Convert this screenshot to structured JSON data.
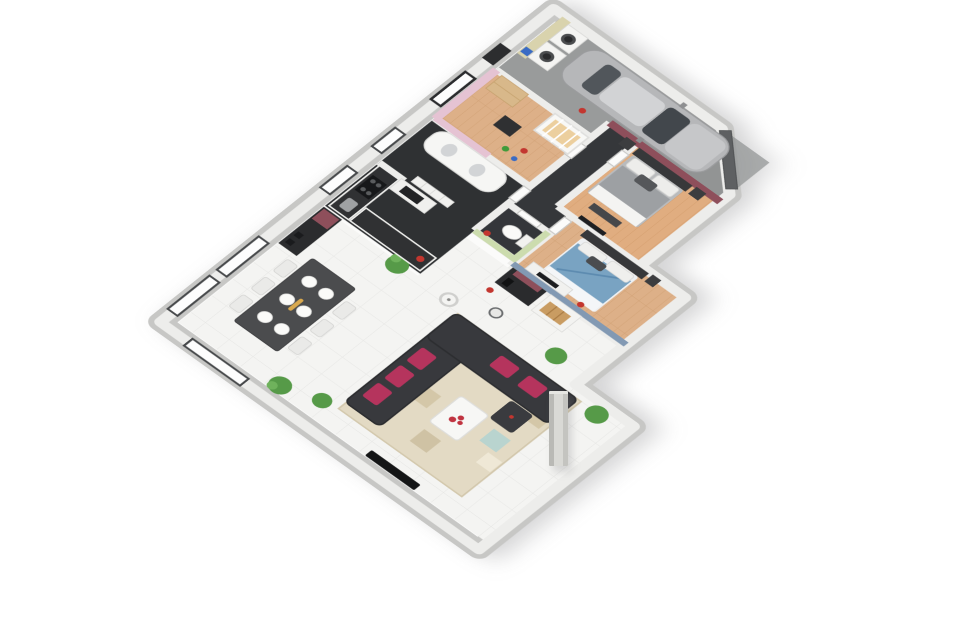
{
  "scene": {
    "type": "3d-isometric-floor-plan",
    "title": "3D isometric floor plan of a single-storey house with garage",
    "camera": "axonometric view from the south-east, plan rotated about 40 degrees",
    "background": "#ffffff",
    "palette": {
      "tile_floor": "#f4f4f2",
      "tile_grid": "#e6e6e4",
      "wood_floor": "#ddb088",
      "wood_floor_master": "#e0ad80",
      "dark_tile_floor": "#2f3133",
      "concrete_floor": "#999b9b",
      "wall": "#ededeb",
      "plinth": "#c7c7c5",
      "accent_pink": "#e5c3d3",
      "accent_green": "#ccdcae",
      "accent_burgundy": "#8e4f5b",
      "accent_blue_gray": "#8299b3",
      "sofa_dark": "#38393d",
      "cushion_magenta": "#b5345d",
      "car_silver": "#b6b7b9",
      "bed_blue": "#79a3c2",
      "bed_gray": "#9da0a3",
      "garage_door_gray": "#5e6062",
      "window_frame": "#46484a",
      "plant_green": "#569a48",
      "red_accent": "#c3362f"
    },
    "rooms": [
      {
        "id": "living",
        "name": "Living and dining room",
        "floor": "white tile",
        "furniture": [
          "corner sofa with magenta cushions",
          "patterned area rug",
          "white coffee table with red flowers",
          "dark ottoman",
          "flat TV",
          "dining table with six white place settings",
          "six chairs",
          "black sideboard with burgundy door",
          "potted plants",
          "floor lamp"
        ]
      },
      {
        "id": "kitchen",
        "name": "Kitchen",
        "floor": "dark tile",
        "furniture": [
          "L-shaped counter with black worktop",
          "cooktop",
          "sink",
          "tall oven column",
          "red bowl"
        ]
      },
      {
        "id": "bathroom",
        "name": "Bathroom",
        "floor": "dark tile",
        "furniture": [
          "curved white vanity with twin basins",
          "drawer column",
          "small window"
        ]
      },
      {
        "id": "wc",
        "name": "WC",
        "accent_wall": "green",
        "furniture": [
          "toilet",
          "red bin"
        ]
      },
      {
        "id": "nursery",
        "name": "Nursery",
        "accent_wall": "pink",
        "floor": "wood",
        "furniture": [
          "cot with yellow mattress",
          "wooden wardrobe",
          "black changing easel",
          "toys"
        ]
      },
      {
        "id": "laundry",
        "name": "Laundry and entrance",
        "floor": "concrete",
        "furniture": [
          "washing machine",
          "dryer",
          "beige worktop",
          "blue detergent box",
          "dark entry door"
        ]
      },
      {
        "id": "hallway",
        "name": "Hallway",
        "floor": "dark tile",
        "furniture": [
          "white interior doors"
        ]
      },
      {
        "id": "master",
        "name": "Master bedroom",
        "accent_wall": "burgundy",
        "floor": "wood",
        "furniture": [
          "double bed with gray and white bedding",
          "two nightstands",
          "bench",
          "wall TV"
        ]
      },
      {
        "id": "bedroom2",
        "name": "Second bedroom",
        "accent_wall": "blue-gray",
        "floor": "wood",
        "furniture": [
          "double bed with blue bedding",
          "white dresser with TV",
          "nightstand",
          "red vase"
        ]
      },
      {
        "id": "garage",
        "name": "Garage",
        "floor": "concrete",
        "furniture": [
          "silver car",
          "dark gray garage door on chamfered corner",
          "red extinguisher"
        ]
      },
      {
        "id": "nook",
        "name": "TV nook",
        "floor": "white tile",
        "furniture": [
          "black hi-fi cabinet",
          "white buffet with wooden trays",
          "wall clock",
          "potted plant"
        ]
      },
      {
        "id": "exterior",
        "name": "Porch",
        "furniture": [
          "free-standing concrete pillar"
        ]
      }
    ]
  }
}
